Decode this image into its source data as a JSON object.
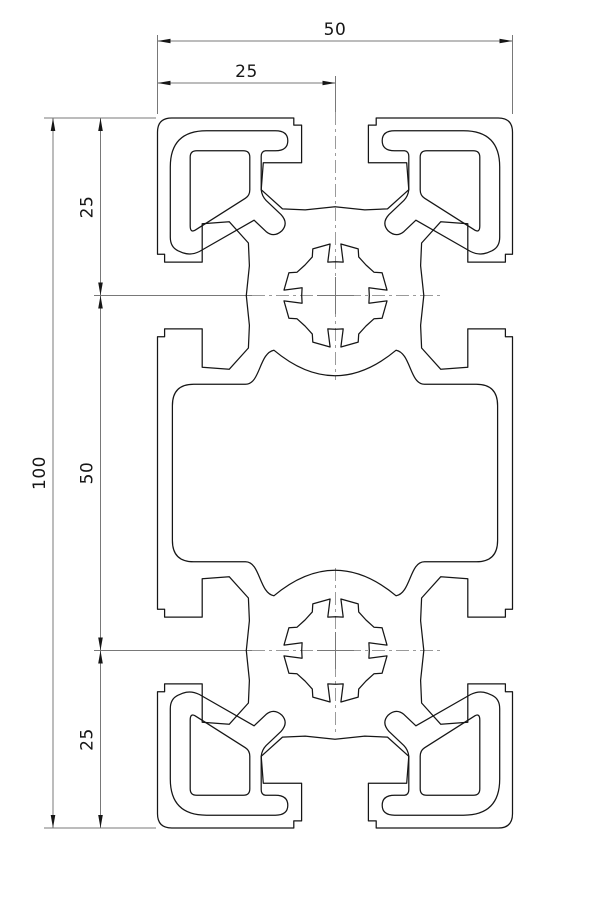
{
  "drawing": {
    "kind": "extrusion-profile-cross-section",
    "dimensions": {
      "top_width": {
        "label": "50"
      },
      "top_half_width": {
        "label": "25"
      },
      "left_total_height": {
        "label": "100"
      },
      "left_middle": {
        "label": "50"
      },
      "left_top": {
        "label": "25"
      },
      "left_bottom": {
        "label": "25"
      }
    },
    "colors": {
      "outline": "#161616",
      "dimension_line": "#787878",
      "center_line": "#9a9a9a",
      "label_text": "#161616",
      "background": "#ffffff"
    }
  }
}
